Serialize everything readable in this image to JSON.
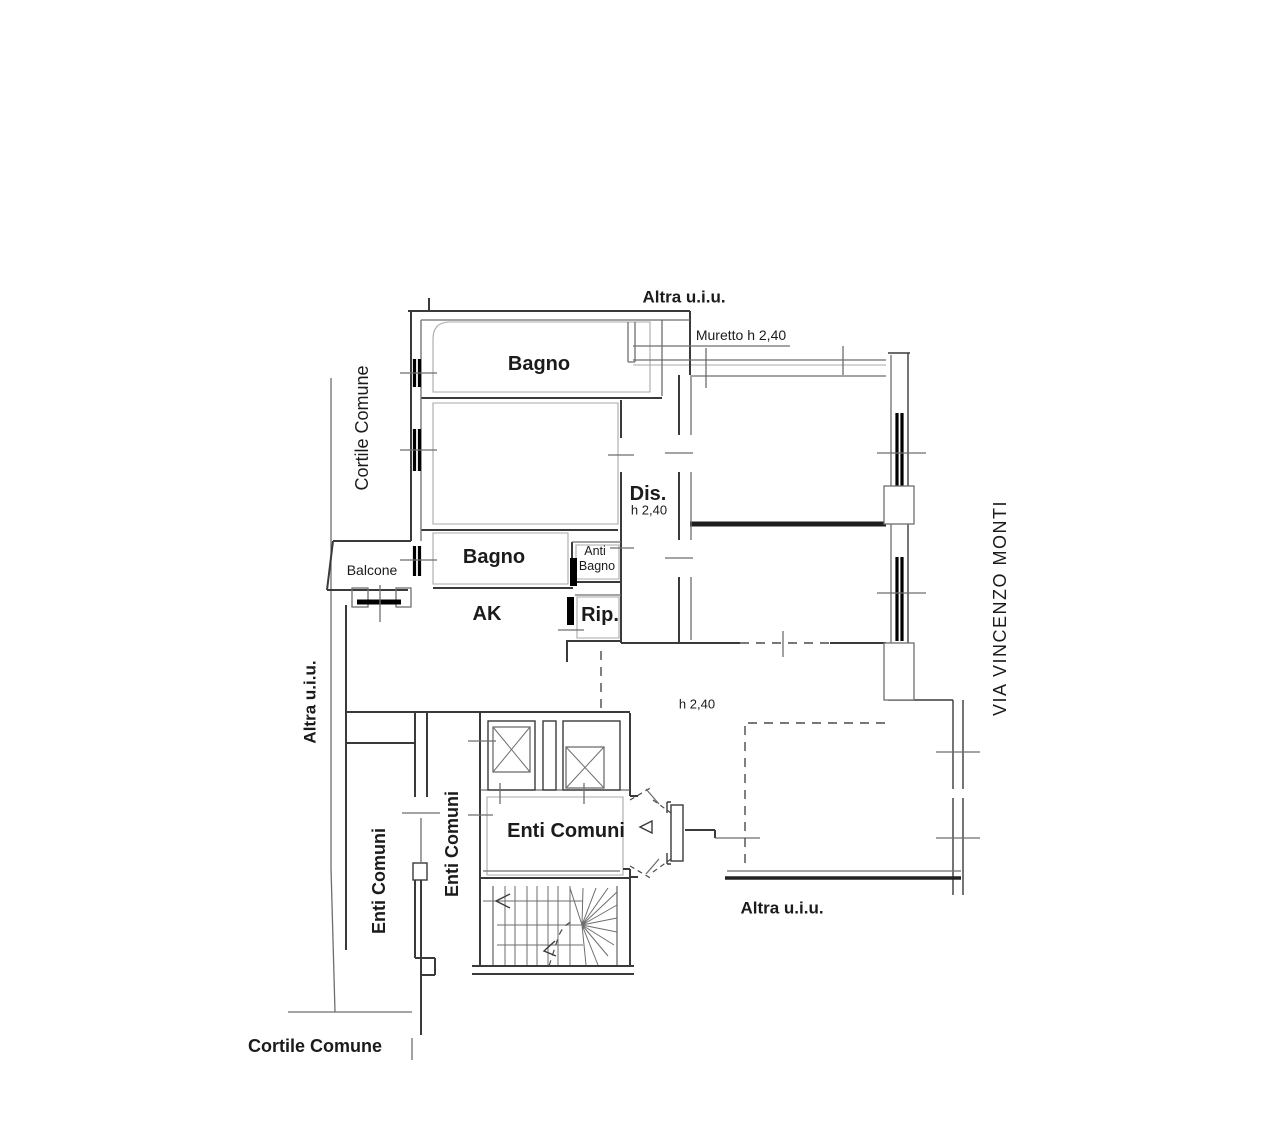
{
  "theme": {
    "background": "#ffffff",
    "ink": "#1b1b1b",
    "wall_dark": "#3a3a3a",
    "wall_mid": "#6e6e6e",
    "wall_light": "#a8a8a8",
    "wall_black": "#000000",
    "dash": "#4a4a4a"
  },
  "labels": {
    "altra_uiu_top": {
      "text": "Altra u.i.u."
    },
    "muretto": {
      "text": "Muretto h 2,40"
    },
    "bagno_top": {
      "text": "Bagno"
    },
    "cortile_comune_left": {
      "text": "Cortile Comune"
    },
    "dis": {
      "text": "Dis."
    },
    "dis_height": {
      "text": "h 2,40"
    },
    "bagno_middle": {
      "text": "Bagno"
    },
    "anti_bagno_line1": {
      "text": "Anti"
    },
    "anti_bagno_line2": {
      "text": "Bagno"
    },
    "balcone": {
      "text": "Balcone"
    },
    "ak": {
      "text": "AK"
    },
    "rip": {
      "text": "Rip."
    },
    "via_vincenzo_monti": {
      "text": "VIA VINCENZO MONTI"
    },
    "altra_uiu_left": {
      "text": "Altra u.i.u."
    },
    "terrace_height": {
      "text": "h 2,40"
    },
    "enti_comuni_hall": {
      "text": "Enti Comuni"
    },
    "enti_comuni_left": {
      "text": "Enti Comuni"
    },
    "enti_comuni_mid": {
      "text": "Enti Comuni"
    },
    "altra_uiu_bottom": {
      "text": "Altra u.i.u."
    },
    "cortile_comune_bottom": {
      "text": "Cortile Comune"
    }
  }
}
